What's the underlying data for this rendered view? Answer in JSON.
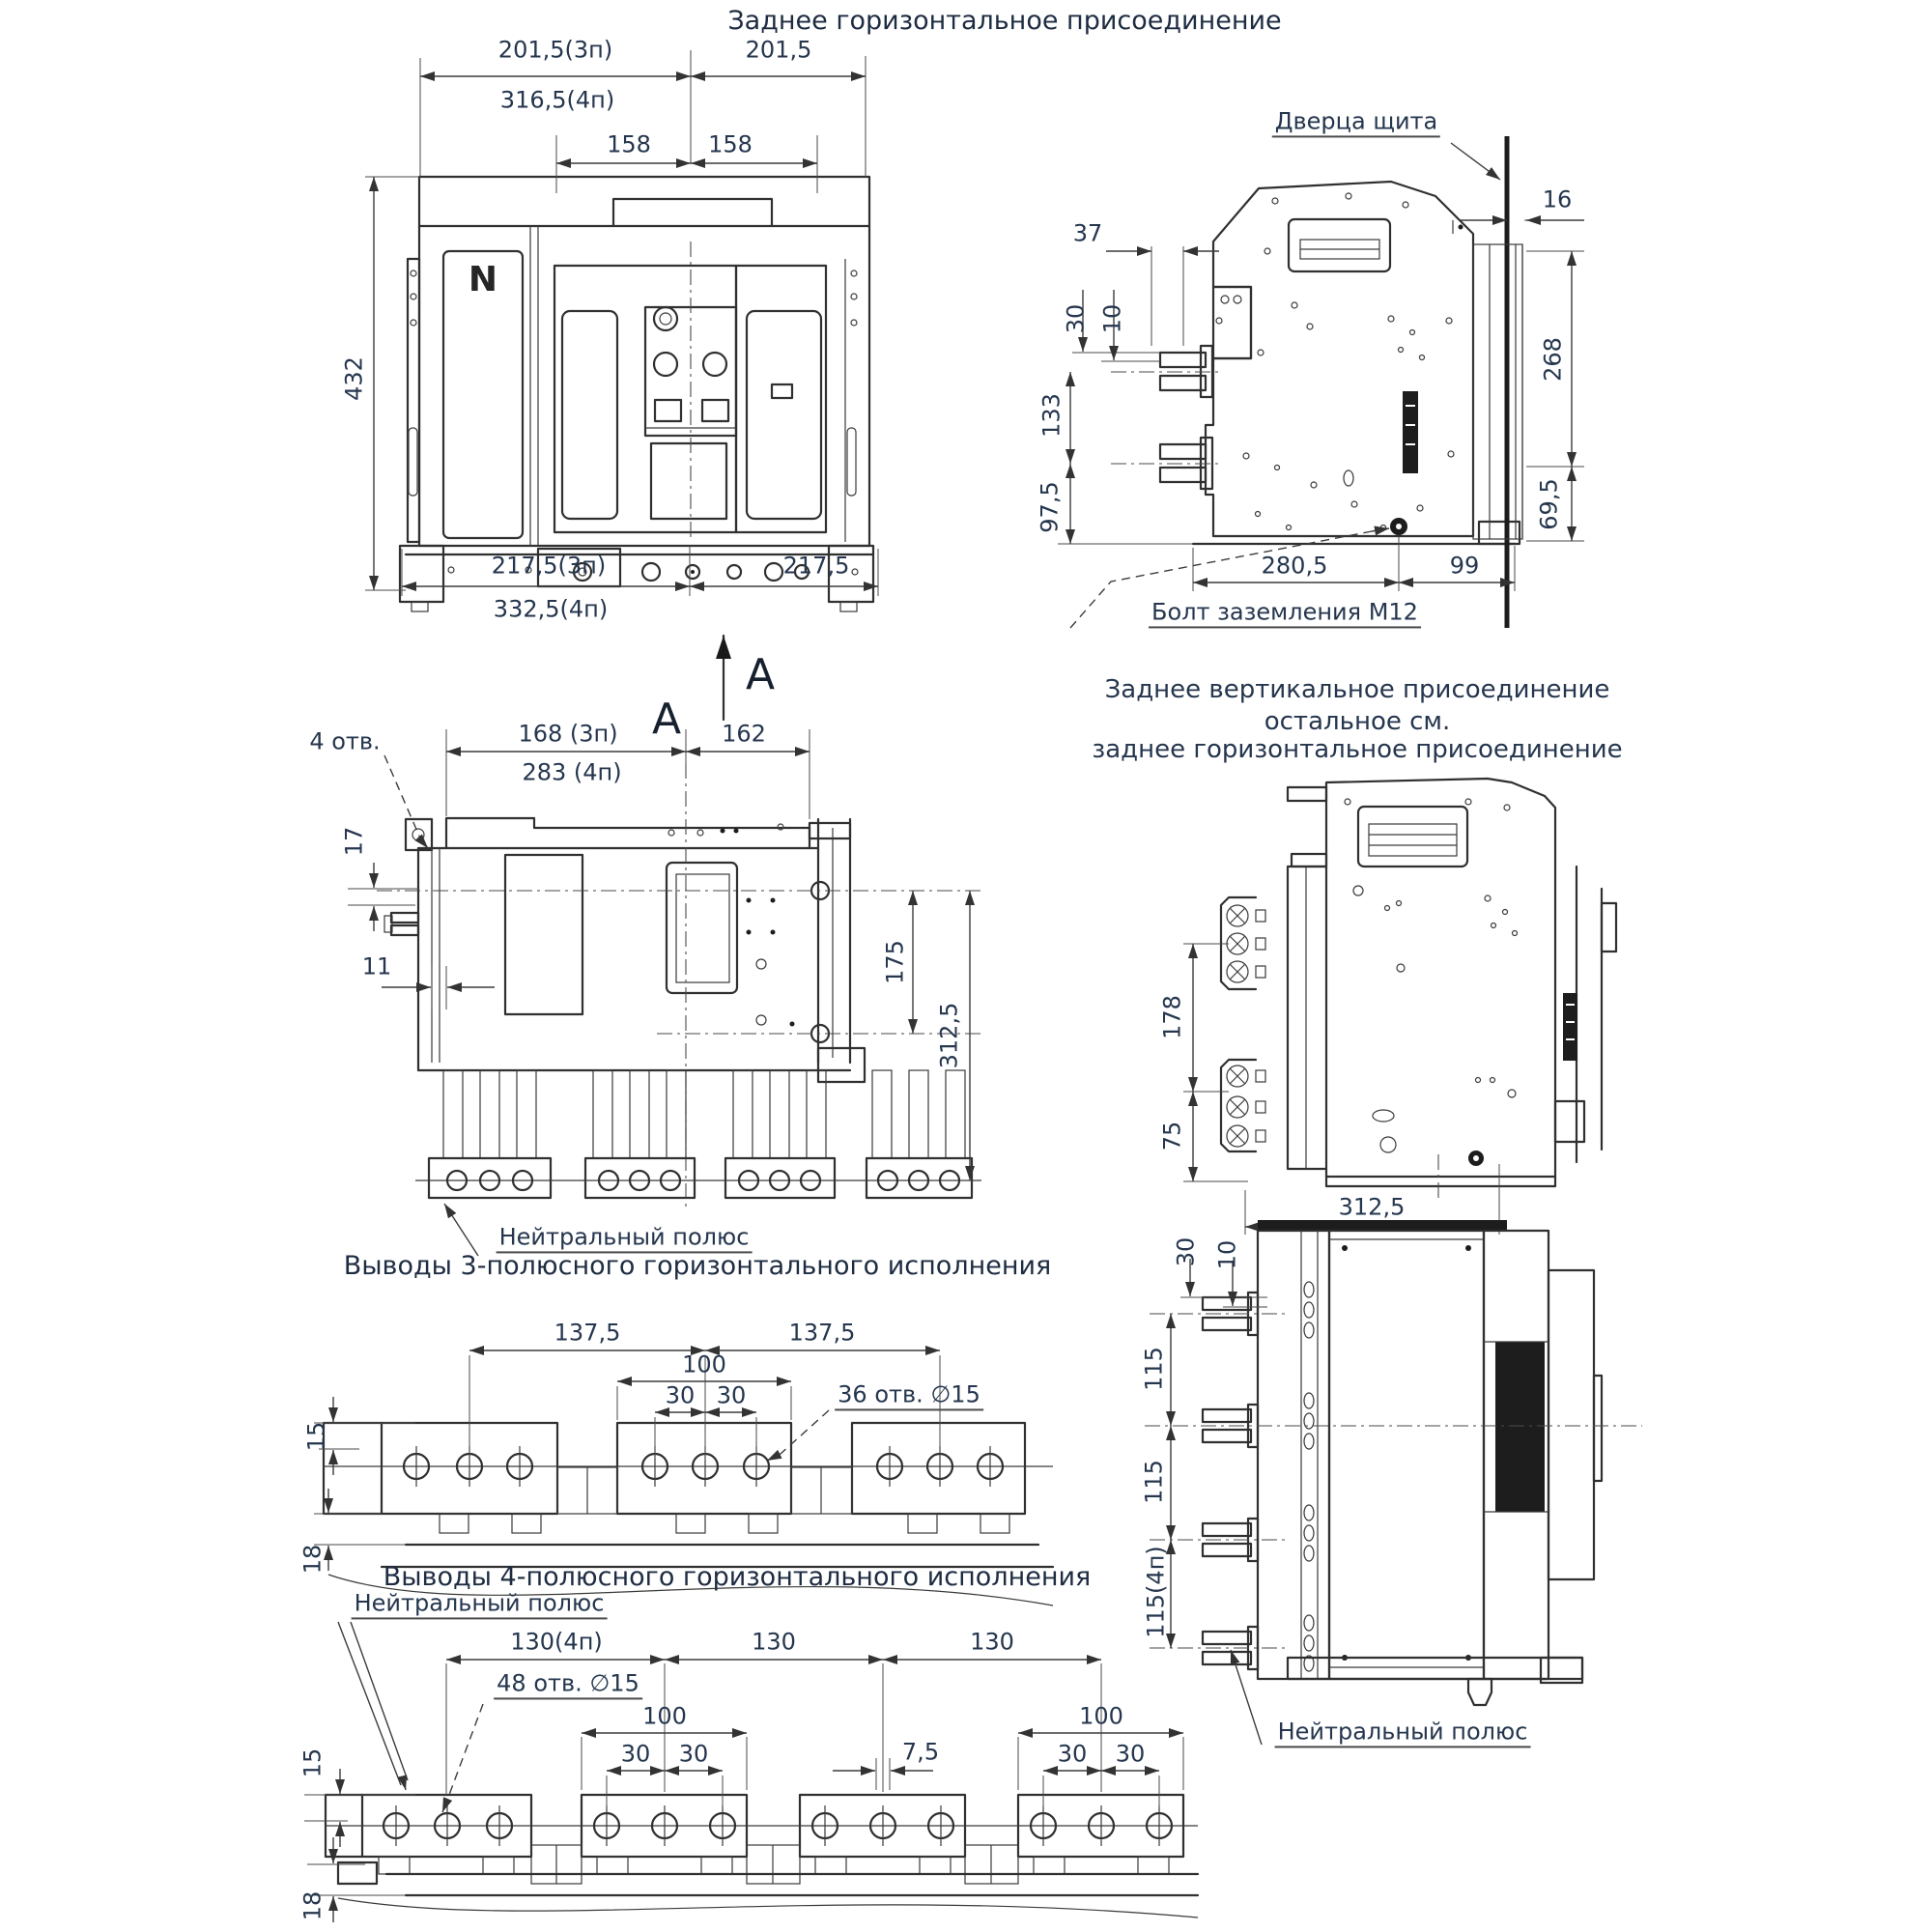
{
  "titles": {
    "rear_horizontal": "Заднее горизонтальное присоединение",
    "rear_vertical_note_line1": "Заднее вертикальное присоединение",
    "rear_vertical_note_line2": "остальное см.",
    "rear_vertical_note_line3": "заднее горизонтальное присоединение",
    "terminals_3p": "Выводы 3-полюсного горизонтального исполнения",
    "terminals_4p": "Выводы 4-полюсного горизонтального исполнения"
  },
  "section_marks": {
    "letter_right": "А",
    "letter_left": "А"
  },
  "callouts": {
    "panel_door": "Дверца щита",
    "ground_bolt": "Болт заземления М12",
    "neutral_pole_plan": "Нейтральный полюс",
    "neutral_pole_4p": "Нейтральный полюс",
    "neutral_pole_rear": "Нейтральный полюс",
    "four_holes": "4 отв.",
    "holes_3p": "36 отв. ∅15",
    "holes_4p": "48 отв. ∅15",
    "pole_marking": "N"
  },
  "front_view": {
    "dims": {
      "width_3p": "201,5(3п)",
      "width_4p": "316,5(4п)",
      "width_right": "201,5",
      "pitch_left": "158",
      "pitch_right": "158",
      "height": "432",
      "base_3p": "217,5(3п)",
      "base_4p": "332,5(4п)",
      "base_right": "217,5"
    }
  },
  "side_view_top": {
    "dims": {
      "stud_offset": "37",
      "stud_upper": "30",
      "stud_lower": "10",
      "door_gap": "16",
      "height_upper": "268",
      "height_lower": "69,5",
      "stud_pitch": "133",
      "stud_bottom": "97,5",
      "depth": "280,5",
      "front": "99"
    }
  },
  "plan_view": {
    "dims": {
      "width_3p": "168 (3п)",
      "width_4p": "283 (4п)",
      "width_right": "162",
      "hole_offset": "17",
      "edge_offset": "11",
      "depth_rear": "175",
      "depth_total": "312,5"
    }
  },
  "side_view_vertical": {
    "dims": {
      "pad_pitch": "178",
      "pad_bottom": "75",
      "depth": "312,5"
    }
  },
  "busbar_3p": {
    "dims": {
      "pitch_left": "137,5",
      "pitch_right": "137,5",
      "pad_width": "100",
      "hole_left": "30",
      "hole_right": "30",
      "thickness": "15",
      "support": "18"
    }
  },
  "busbar_4p": {
    "dims": {
      "pitch_neutral": "130(4п)",
      "pitch_2": "130",
      "pitch_3": "130",
      "pad_width_left": "100",
      "hole_l1": "30",
      "hole_l2": "30",
      "center_offset": "7,5",
      "pad_width_right": "100",
      "hole_r1": "30",
      "hole_r2": "30",
      "thickness": "15",
      "support": "18"
    }
  },
  "side_view_section": {
    "dims": {
      "stud_upper": "30",
      "stud_lower": "10",
      "pitch_1": "115",
      "pitch_2": "115",
      "pitch_3": "115(4п)"
    }
  }
}
